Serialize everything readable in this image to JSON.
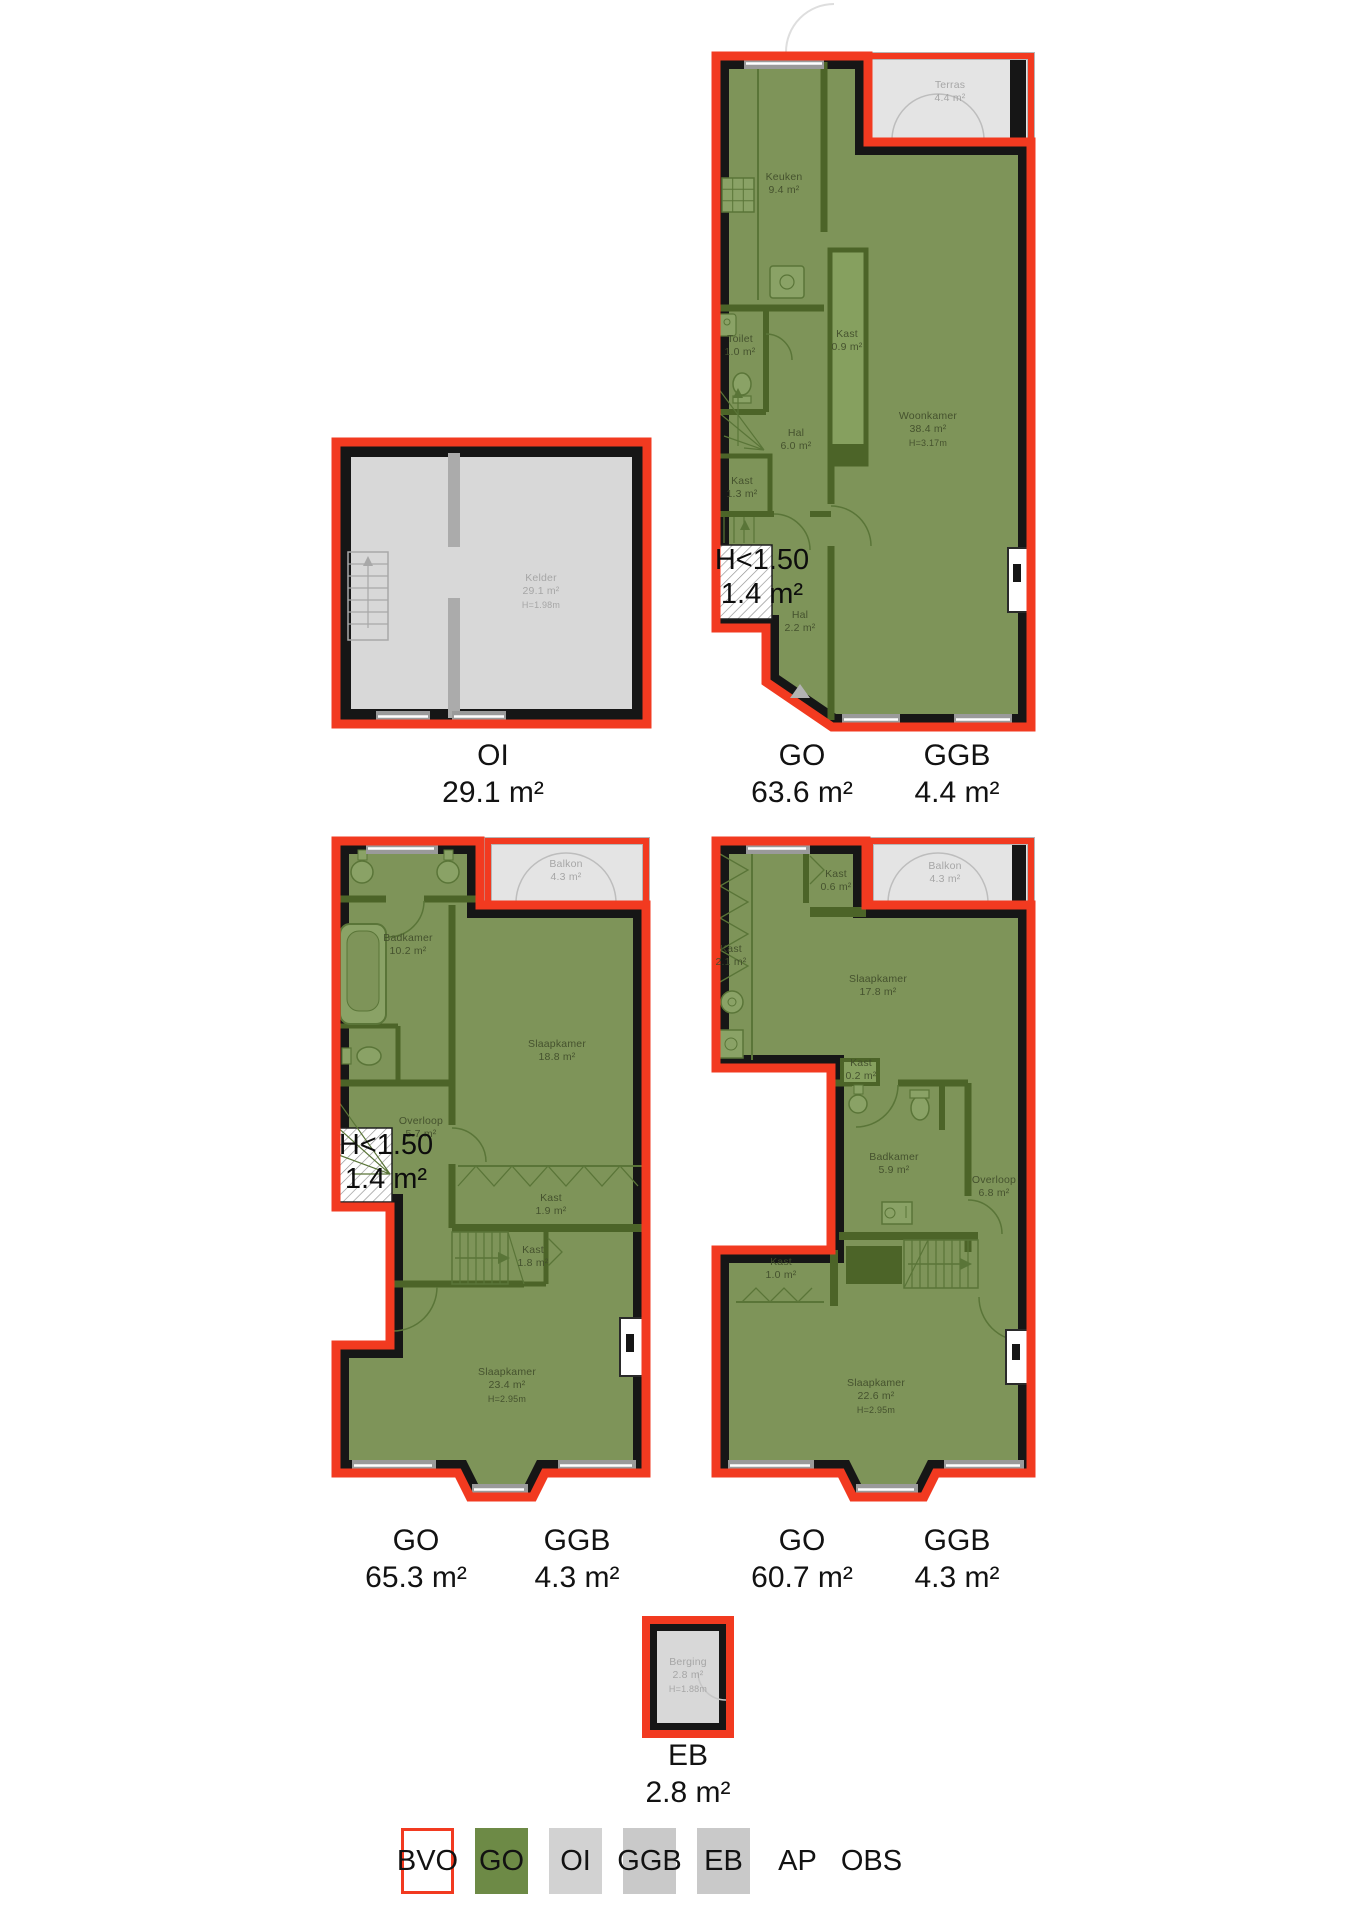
{
  "colors": {
    "bvo_red_outline": "#f23a20",
    "go_green_legend": "#6d8a46",
    "plan_interior_green": "#7e9459",
    "wall_black": "#161616",
    "interior_wall_green": "#4c6428",
    "oi_gray": "#d2d2d2",
    "ggb_gray": "#c9c9c9",
    "outdoor_gray": "#e4e4e4",
    "basement_gray": "#d8d8d8"
  },
  "rooms": [
    {
      "name": "Terras",
      "area": "4.4 m²",
      "tone": "gray"
    },
    {
      "name": "Keuken",
      "area": "9.4 m²"
    },
    {
      "name": "Toilet",
      "area": "1.0 m²"
    },
    {
      "name": "Kast",
      "area": "0.9 m²"
    },
    {
      "name": "Hal",
      "area": "6.0 m²"
    },
    {
      "name": "Kast",
      "area": "1.3 m²"
    },
    {
      "name": "Woonkamer",
      "area": "38.4 m²",
      "h": "H=3.17m"
    },
    {
      "name": "Hal",
      "area": "2.2 m²"
    },
    {
      "name": "Kelder",
      "area": "29.1 m²",
      "h": "H=1.98m",
      "tone": "gray"
    },
    {
      "name": "Balkon",
      "area": "4.3 m²",
      "tone": "gray"
    },
    {
      "name": "Badkamer",
      "area": "10.2 m²"
    },
    {
      "name": "Slaapkamer",
      "area": "18.8 m²"
    },
    {
      "name": "Overloop",
      "area": "5.7 m²"
    },
    {
      "name": "Kast",
      "area": "1.9 m²"
    },
    {
      "name": "Kast",
      "area": "1.8 m²"
    },
    {
      "name": "Slaapkamer",
      "area": "23.4 m²",
      "h": "H=2.95m"
    },
    {
      "name": "Kast",
      "area": "0.6 m²"
    },
    {
      "name": "Balkon",
      "area": "4.3 m²",
      "tone": "gray"
    },
    {
      "name": "Kast",
      "area": "2.1 m²"
    },
    {
      "name": "Slaapkamer",
      "area": "17.8 m²"
    },
    {
      "name": "Kast",
      "area": "0.2 m²"
    },
    {
      "name": "Badkamer",
      "area": "5.9 m²"
    },
    {
      "name": "Overloop",
      "area": "6.8 m²"
    },
    {
      "name": "Kast",
      "area": "1.0 m²"
    },
    {
      "name": "Slaapkamer",
      "area": "22.6 m²",
      "h": "H=2.95m"
    },
    {
      "name": "Berging",
      "area": "2.8 m²",
      "h": "H=1.88m",
      "tone": "gray"
    }
  ],
  "lowh": [
    {
      "line1": "H<1.50",
      "line2": "1.4 m²"
    },
    {
      "line1": "H<1.50",
      "line2": "1.4 m²"
    }
  ],
  "captions": [
    {
      "label": "OI",
      "value": "29.1 m²"
    },
    {
      "label": "GO",
      "value": "63.6 m²"
    },
    {
      "label": "GGB",
      "value": "4.4 m²"
    },
    {
      "label": "GO",
      "value": "65.3 m²"
    },
    {
      "label": "GGB",
      "value": "4.3 m²"
    },
    {
      "label": "GO",
      "value": "60.7 m²"
    },
    {
      "label": "GGB",
      "value": "4.3 m²"
    },
    {
      "label": "EB",
      "value": "2.8 m²"
    }
  ],
  "legend": {
    "items": [
      {
        "label": "BVO",
        "fill": "#ffffff",
        "border": "#f23a20"
      },
      {
        "label": "GO",
        "fill": "#6d8a46"
      },
      {
        "label": "OI",
        "fill": "#d2d2d2"
      },
      {
        "label": "GGB",
        "fill": "#c9c9c9"
      },
      {
        "label": "EB",
        "fill": "#c9c9c9"
      },
      {
        "label": "AP"
      },
      {
        "label": "OBS"
      }
    ]
  }
}
